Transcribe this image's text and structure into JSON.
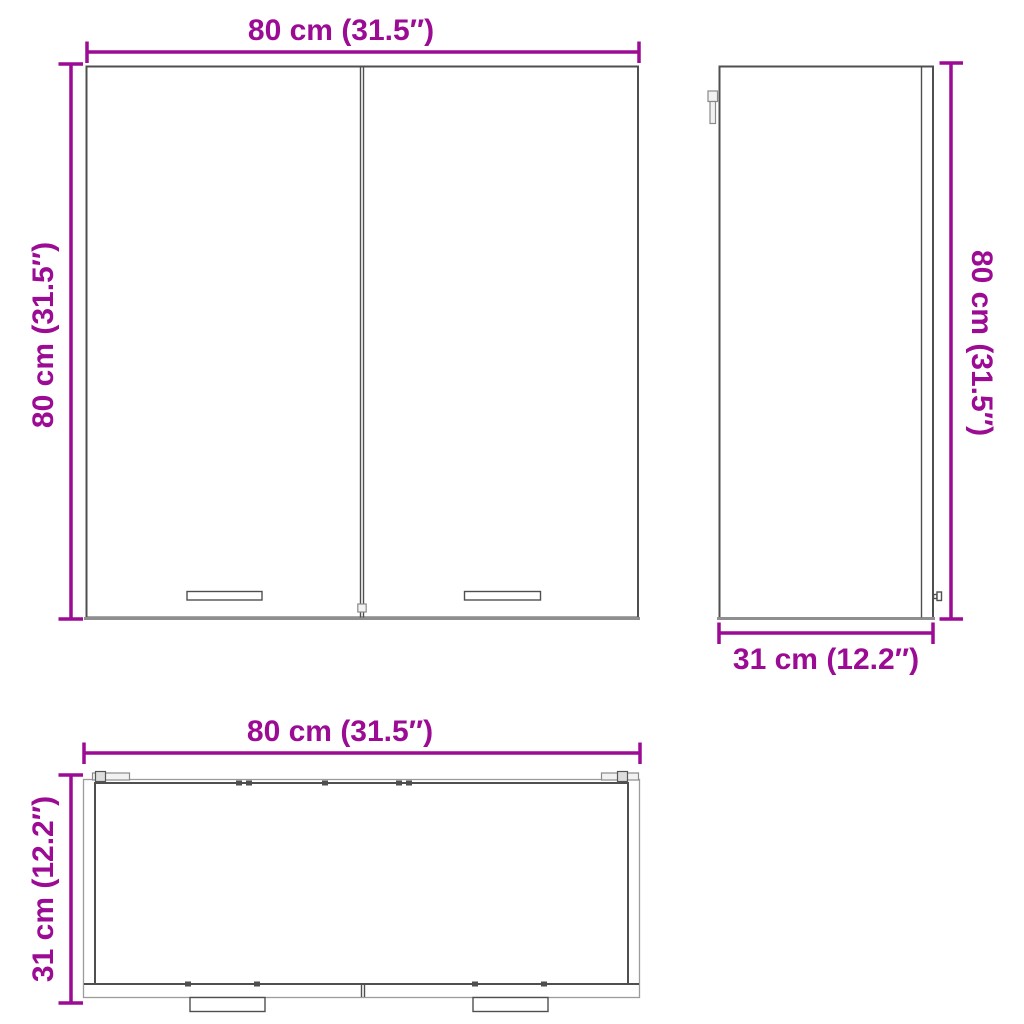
{
  "diagram": {
    "front_view": {
      "width_label": "80 cm (31.5″)",
      "height_label": "80 cm (31.5″)"
    },
    "side_view": {
      "height_label": "80 cm (31.5″)",
      "depth_label": "31 cm (12.2″)"
    },
    "top_view": {
      "width_label": "80 cm (31.5″)",
      "depth_label": "31 cm (12.2″)"
    },
    "colors": {
      "dimension_accent": "#9b0b94",
      "outline_dark": "#4f4f4f",
      "outline_light": "#9c9c9c",
      "background": "#ffffff"
    }
  }
}
